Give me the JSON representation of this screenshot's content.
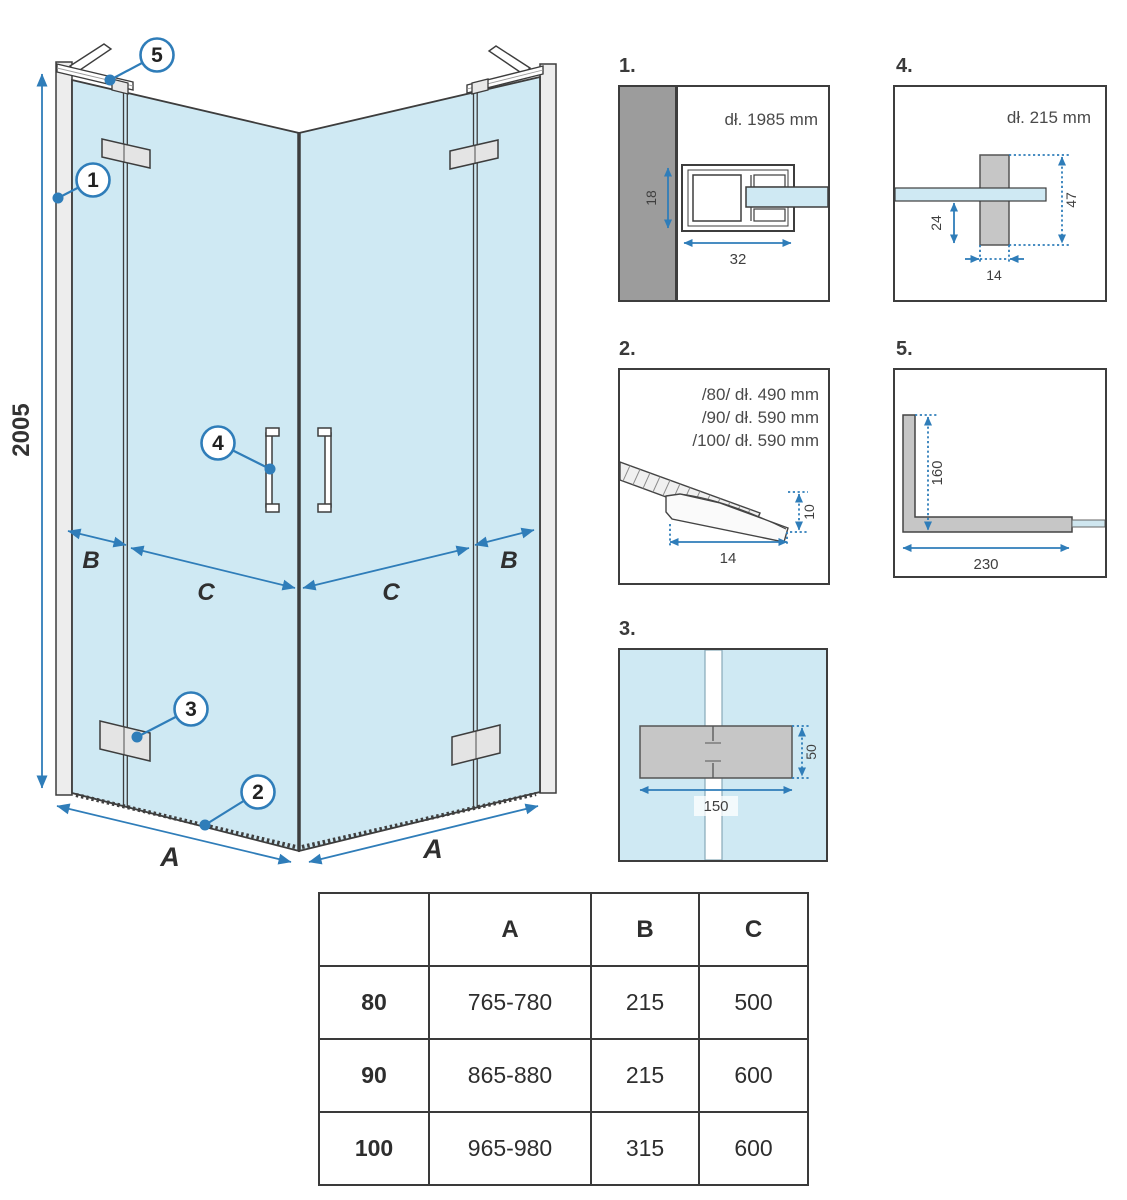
{
  "colors": {
    "accent": "#2f7db9",
    "glass": "#cfe9f3",
    "line": "#3d3d3d",
    "wall": "#9c9c9c",
    "metal": "#c6c6c6"
  },
  "main": {
    "height_label": "2005",
    "a_left": "A",
    "a_right": "A",
    "b_left": "B",
    "b_right": "B",
    "c_left": "C",
    "c_right": "C",
    "callouts": {
      "c1": "1",
      "c2": "2",
      "c3": "3",
      "c4": "4",
      "c5": "5"
    }
  },
  "details": {
    "d1": {
      "number": "1.",
      "length_label": "dł. 1985 mm",
      "dim_depth": "18",
      "dim_width": "32"
    },
    "d2": {
      "number": "2.",
      "line_80": "/80/ dł. 490 mm",
      "line_90": "/90/ dł. 590 mm",
      "line_100": "/100/ dł. 590 mm",
      "dim_height": "10",
      "dim_width": "14"
    },
    "d3": {
      "number": "3.",
      "dim_height": "50",
      "dim_width": "150"
    },
    "d4": {
      "number": "4.",
      "length_label": "dł. 215 mm",
      "dim_lower": "24",
      "dim_height": "47",
      "dim_width": "14"
    },
    "d5": {
      "number": "5.",
      "dim_height": "160",
      "dim_width": "230"
    }
  },
  "table": {
    "headers": [
      "",
      "A",
      "B",
      "C"
    ],
    "rows": [
      {
        "size": "80",
        "a": "765-780",
        "b": "215",
        "c": "500"
      },
      {
        "size": "90",
        "a": "865-880",
        "b": "215",
        "c": "600"
      },
      {
        "size": "100",
        "a": "965-980",
        "b": "315",
        "c": "600"
      }
    ]
  }
}
